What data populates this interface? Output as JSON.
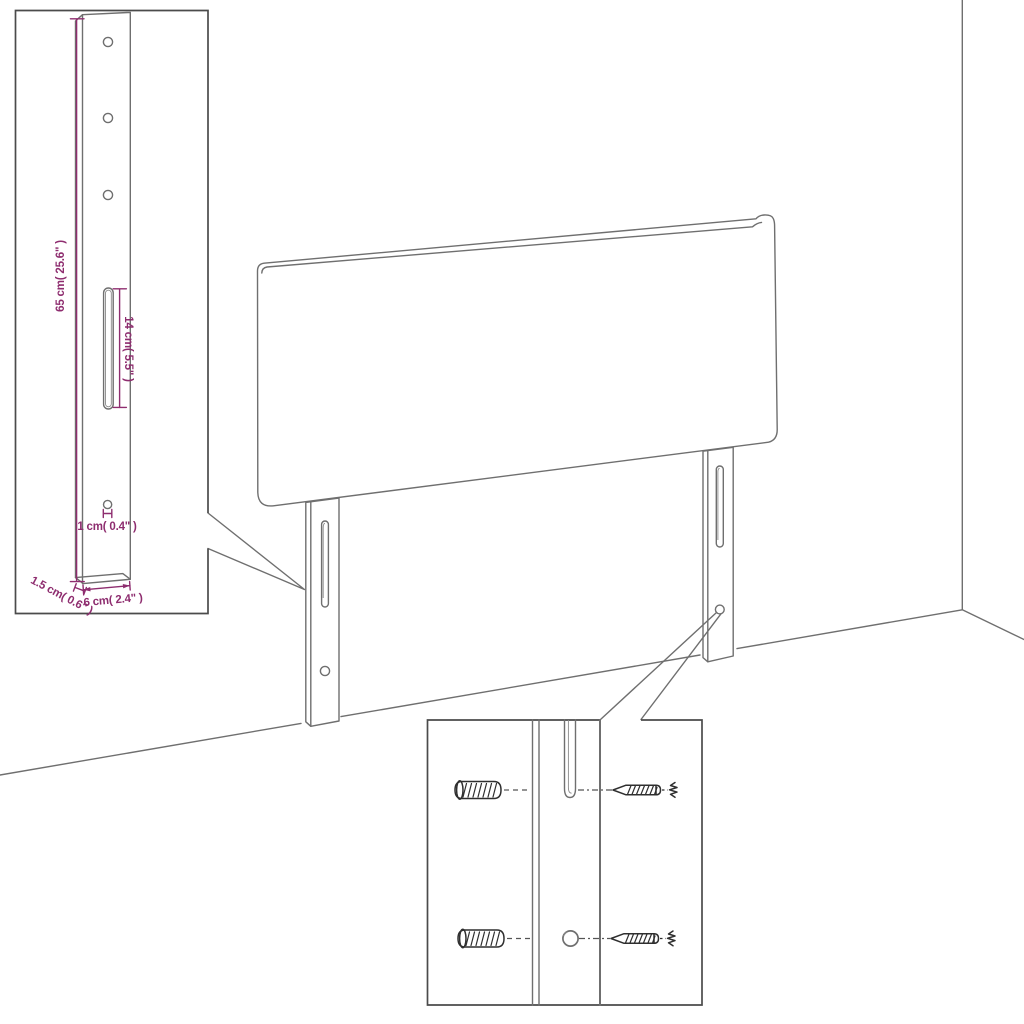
{
  "diagram": {
    "kind": "headboard-assembly-dimension-diagram",
    "insets": {
      "bracket_detail": {
        "labels": {
          "height": "65 cm( 25.6\" )",
          "slot_length": "14 cm( 5.5\" )",
          "hole": "1 cm( 0.4\" )",
          "depth": "1.5 cm( 0.6\" )",
          "width": "6 cm( 2.4\" )"
        }
      },
      "mounting_detail": {
        "hardware": [
          "wall-anchor",
          "screw",
          "wall-anchor",
          "screw"
        ]
      }
    },
    "colors": {
      "dimension": "#8e2d6f",
      "drawing_line": "#6f6f6f",
      "inset_border": "#4b4b4b",
      "hardware_line": "#2f2f2f",
      "background": "#ffffff"
    }
  }
}
